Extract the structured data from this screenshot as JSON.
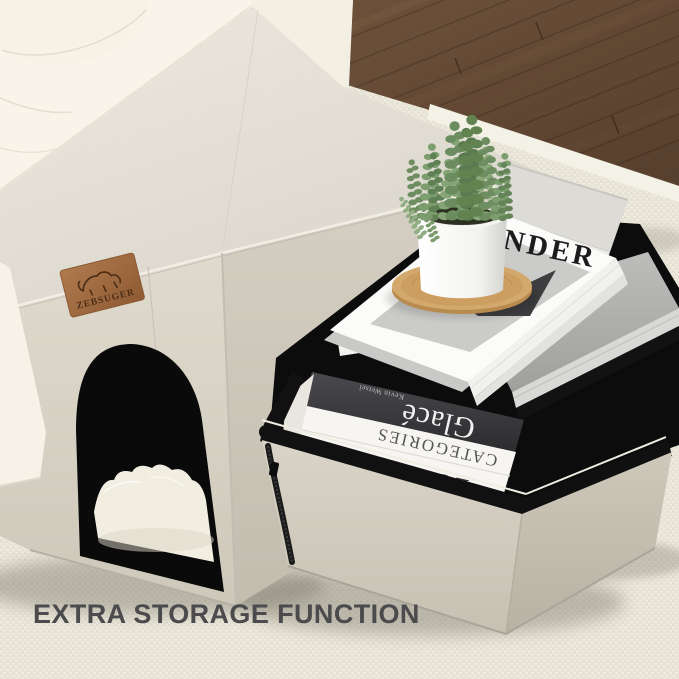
{
  "scene": {
    "description": "Beige fabric pet house ottoman beside an opened storage ottoman filled with books, topped by a succulent plant; cream sofa and wood floor in background",
    "caption": "EXTRA STORAGE FUNCTION",
    "brand_patch": {
      "label": "ZEBSUGER"
    },
    "books": {
      "magazine_title_visible": "NDER",
      "spine_glace_title": "Glacé",
      "spine_glace_author": "Kevin Wetsel",
      "spine_categories": "CATEGORIES",
      "spine_loewe": "LOEWE"
    },
    "colors": {
      "carpet": "#eae6da",
      "wood_floor": "#6e523b",
      "sofa": "#f7f3e8",
      "ottoman_fabric": "#ddd8cc",
      "storage_interior": "#0c0c0c",
      "patch_leather": "#a9744a",
      "caption_text": "#4b4b4d",
      "plant_green": "#7a9a6c",
      "coaster_bamboo": "#c99b60"
    }
  }
}
